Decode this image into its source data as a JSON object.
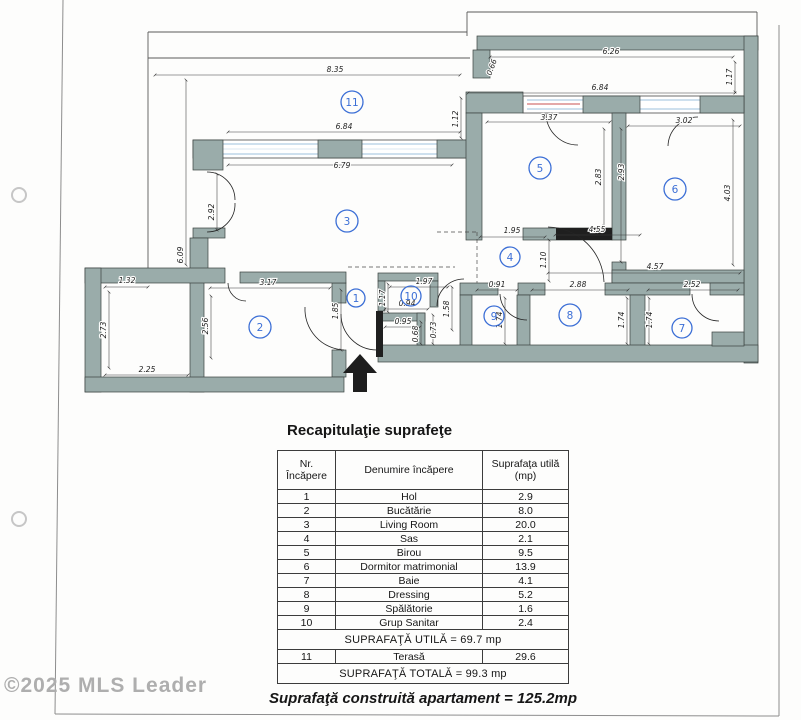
{
  "watermark": "©2025 MLS Leader",
  "plan": {
    "room_numbers": {
      "r1": "1",
      "r2": "2",
      "r3": "3",
      "r4": "4",
      "r5": "5",
      "r6": "6",
      "r7": "7",
      "r8": "8",
      "r9": "9",
      "r10": "10",
      "r11": "11"
    },
    "dims": {
      "d835": "8.35",
      "d626": "6.26",
      "d066": "0.66",
      "d117tr": "1.17",
      "d684b": "6.84",
      "d684a": "6.84",
      "d679": "6.79",
      "d609": "6.09",
      "d292": "2.92",
      "d112": "1.12",
      "d337": "3.37",
      "d302": "3.02",
      "d283": "2.83",
      "d293": "2.93",
      "d403": "4.03",
      "d195": "1.95",
      "d455": "4.55",
      "d110": "1.10",
      "d457": "4.57",
      "d091": "0.91",
      "d288": "2.88",
      "d252": "2.52",
      "d174a": "1.74",
      "d174b": "1.74",
      "d174c": "1.74",
      "d158": "1.58",
      "d197": "1.97",
      "d117b": "1.17",
      "d094": "0.94",
      "d095": "0.95",
      "d068": "0.68",
      "d073": "0.73",
      "d185": "1.85",
      "d317": "3.17",
      "d256": "2.56",
      "d132": "1.32",
      "d273": "2.73",
      "d225": "2.25"
    },
    "colors": {
      "wall": "#9aacaa",
      "room_number_blue": "#3c6fd6",
      "glazing_blue": "#9cc0dc",
      "accent_red": "#c85050"
    }
  },
  "summary": {
    "title": "Recapitulaţie suprafeţe",
    "header": {
      "col1a": "Nr.",
      "col1b": "Încăpere",
      "col2": "Denumire încăpere",
      "col3a": "Suprafaţa utilă",
      "col3b": "(mp)"
    },
    "rows": [
      {
        "nr": "1",
        "name": "Hol",
        "area": "2.9"
      },
      {
        "nr": "2",
        "name": "Bucătărie",
        "area": "8.0"
      },
      {
        "nr": "3",
        "name": "Living Room",
        "area": "20.0"
      },
      {
        "nr": "4",
        "name": "Sas",
        "area": "2.1"
      },
      {
        "nr": "5",
        "name": "Birou",
        "area": "9.5"
      },
      {
        "nr": "6",
        "name": "Dormitor matrimonial",
        "area": "13.9"
      },
      {
        "nr": "7",
        "name": "Baie",
        "area": "4.1"
      },
      {
        "nr": "8",
        "name": "Dressing",
        "area": "5.2"
      },
      {
        "nr": "9",
        "name": "Spălătorie",
        "area": "1.6"
      },
      {
        "nr": "10",
        "name": "Grup Sanitar",
        "area": "2.4"
      }
    ],
    "utila": "SUPRAFAŢĂ UTILĂ = 69.7 mp",
    "terasa": {
      "nr": "11",
      "name": "Terasă",
      "area": "29.6"
    },
    "totala": "SUPRAFAŢĂ TOTALĂ = 99.3 mp",
    "construita": "Suprafaţă construită apartament = 125.2mp"
  }
}
